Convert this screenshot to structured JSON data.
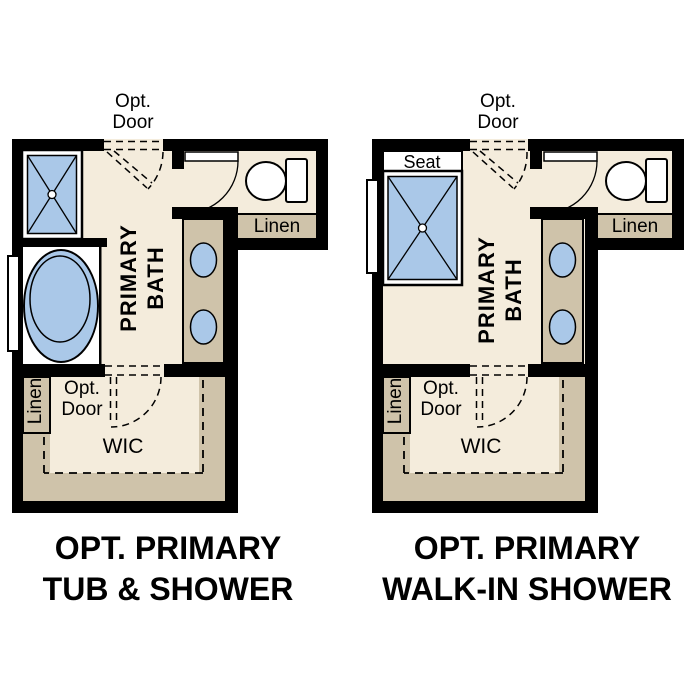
{
  "colors": {
    "wall": "#000000",
    "floor": "#f4ecdc",
    "cabinet_tan": "#cfc3aa",
    "fixture_blue": "#aac8e8",
    "fixture_white": "#ffffff",
    "text": "#000000",
    "background": "#ffffff"
  },
  "plans": [
    {
      "caption": {
        "line1": "OPT. PRIMARY",
        "line2": "TUB & SHOWER"
      },
      "labels": {
        "opt_door_top": {
          "line1": "Opt.",
          "line2": "Door"
        },
        "room": {
          "line1": "PRIMARY",
          "line2": "BATH"
        },
        "linen_bath": "Linen",
        "opt_door_wic": {
          "line1": "Opt.",
          "line2": "Door"
        },
        "linen_wic": "Linen",
        "closet": "WIC"
      },
      "fixtures": [
        "shower",
        "bathtub",
        "toilet",
        "double-sink-vanity",
        "linen-closet",
        "walk-in-closet",
        "window",
        "swing-door",
        "optional-doors"
      ]
    },
    {
      "caption": {
        "line1": "OPT. PRIMARY",
        "line2": "WALK-IN SHOWER"
      },
      "labels": {
        "opt_door_top": {
          "line1": "Opt.",
          "line2": "Door"
        },
        "seat": "Seat",
        "room": {
          "line1": "PRIMARY",
          "line2": "BATH"
        },
        "linen_bath": "Linen",
        "opt_door_wic": {
          "line1": "Opt.",
          "line2": "Door"
        },
        "linen_wic": "Linen",
        "closet": "WIC"
      },
      "fixtures": [
        "walk-in-shower-with-seat",
        "toilet",
        "double-sink-vanity",
        "linen-closet",
        "walk-in-closet",
        "window",
        "swing-door",
        "optional-doors"
      ]
    }
  ]
}
